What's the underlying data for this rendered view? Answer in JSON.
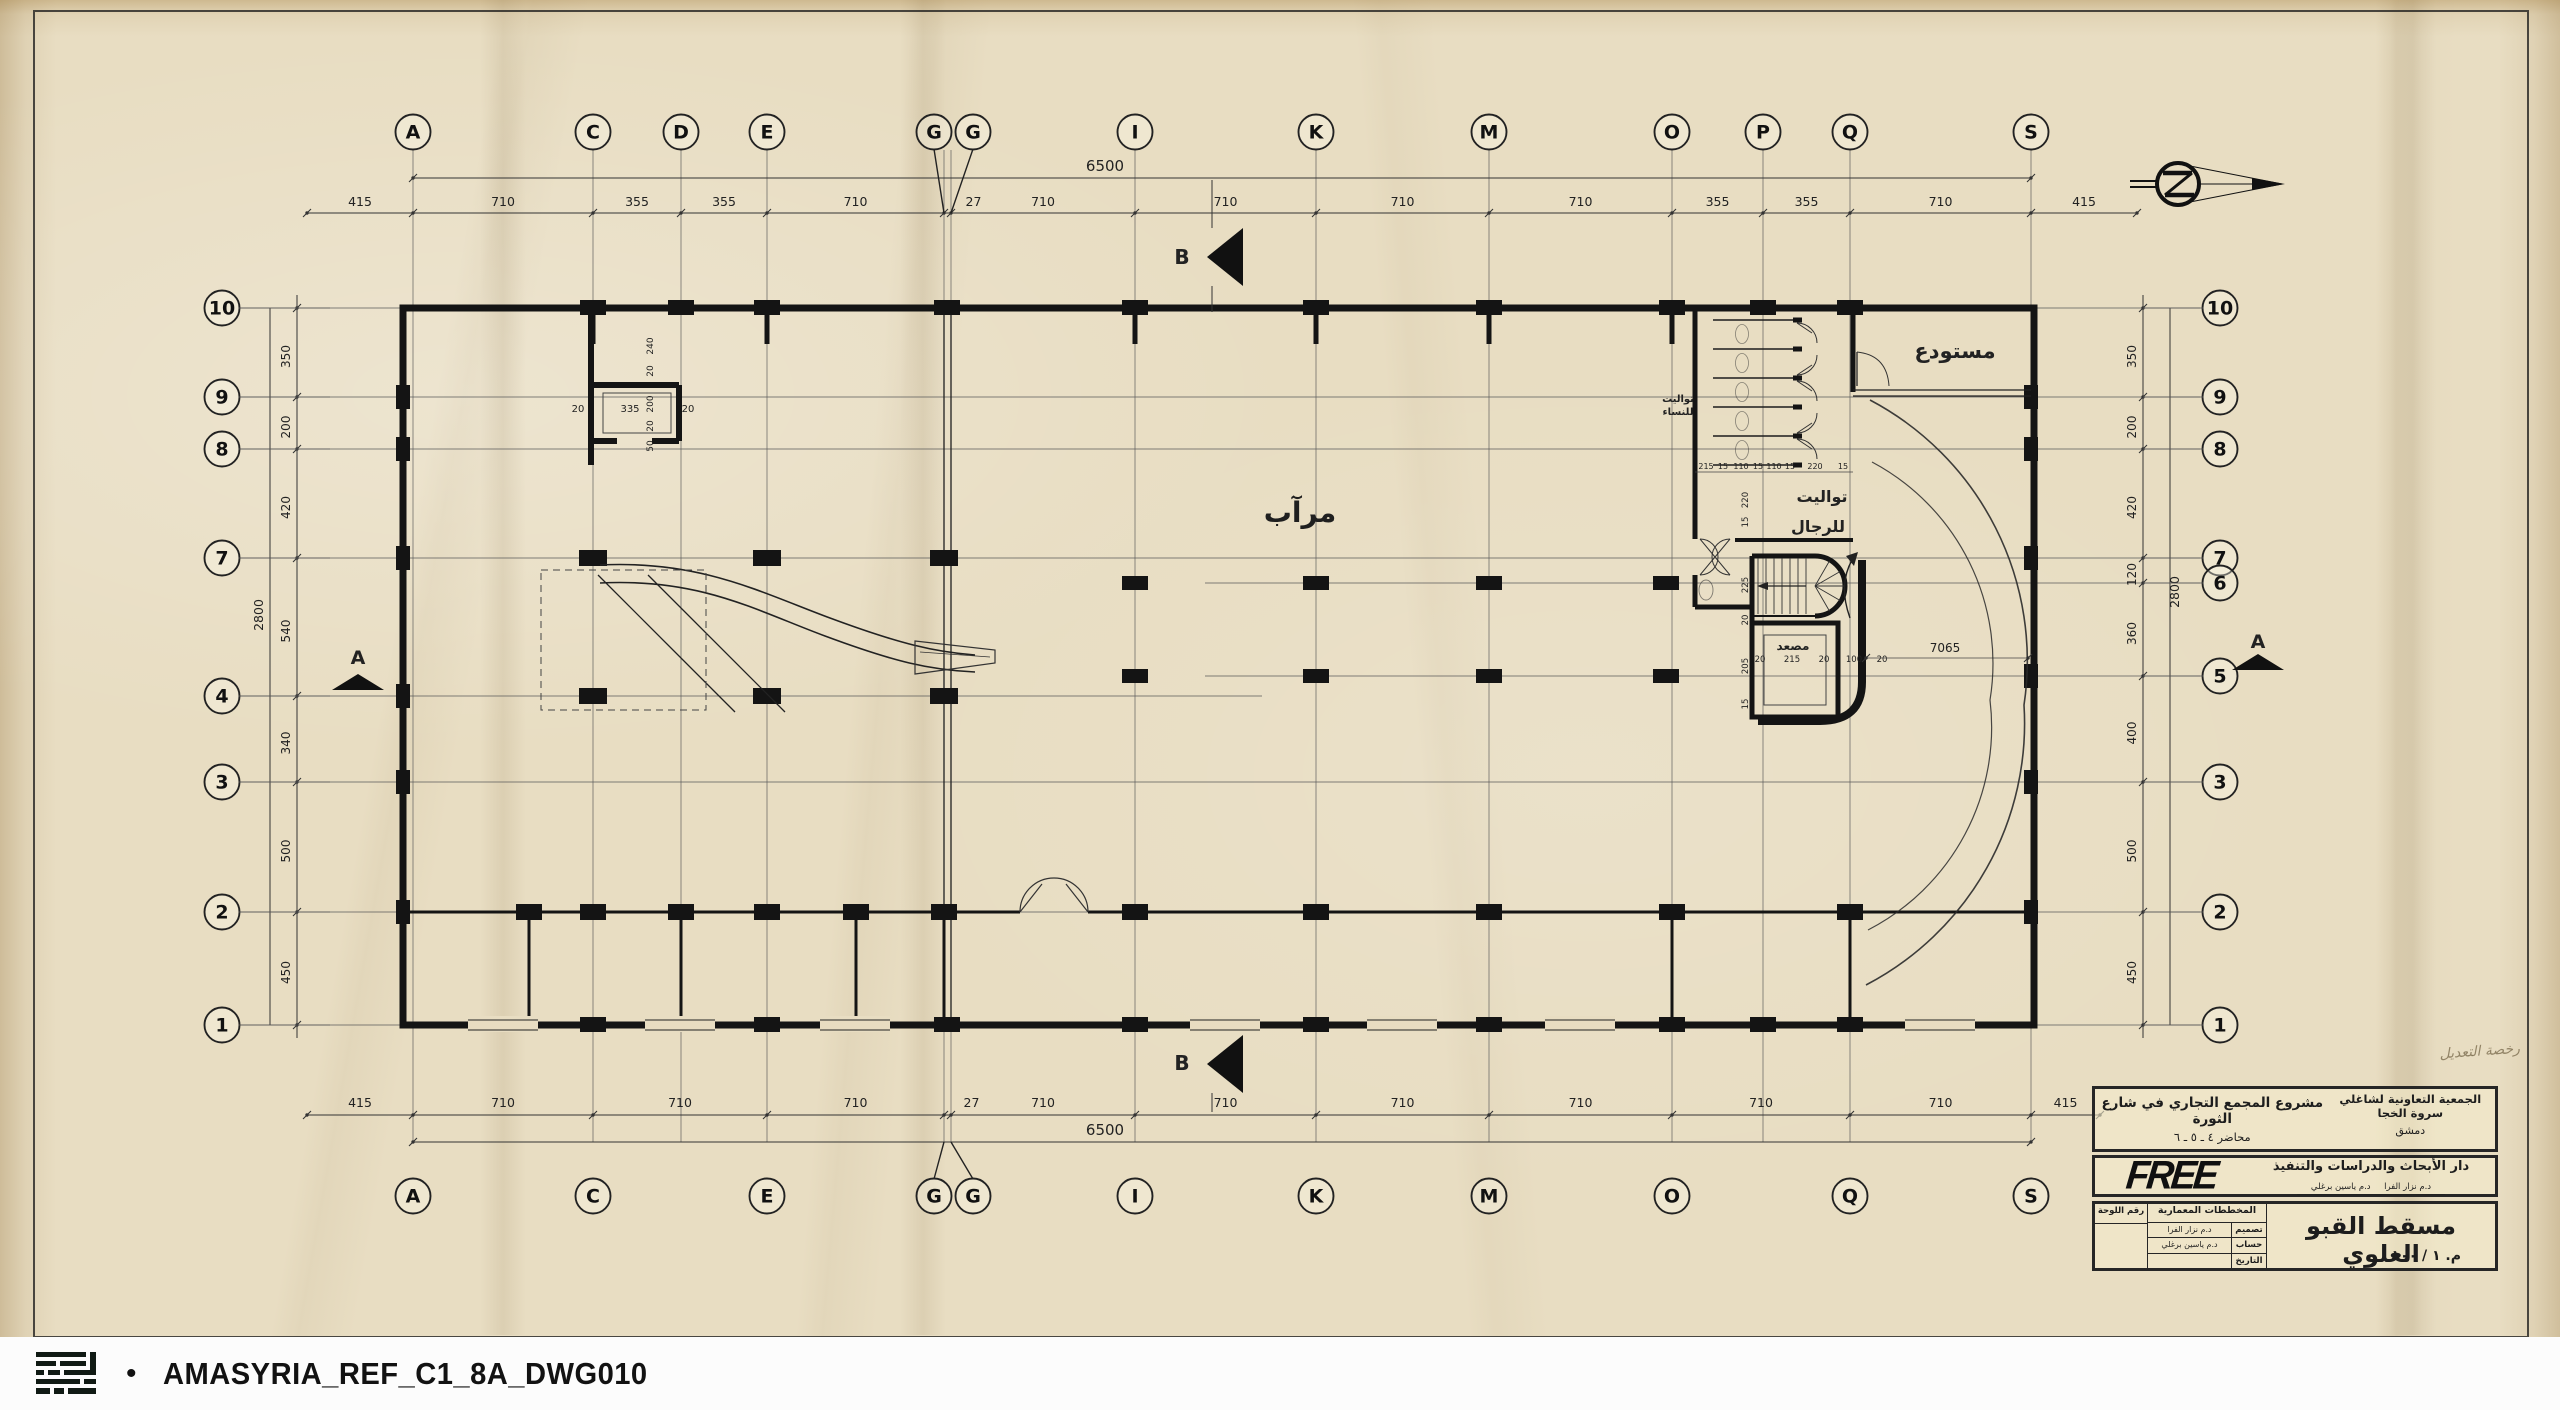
{
  "sheet": {
    "type": "architectural-floor-plan-scan"
  },
  "grid": {
    "top_labels": [
      "A",
      "C",
      "D",
      "E",
      "G",
      "G",
      "I",
      "K",
      "M",
      "O",
      "P",
      "Q",
      "S"
    ],
    "top_dims": [
      "415",
      "710",
      "355",
      "355",
      "710",
      "27",
      "710",
      "710",
      "710",
      "710",
      "355",
      "355",
      "710",
      "415"
    ],
    "top_total": "6500",
    "bottom_labels": [
      "A",
      "C",
      "E",
      "G",
      "G",
      "I",
      "K",
      "M",
      "O",
      "Q",
      "S"
    ],
    "bottom_dims": [
      "415",
      "710",
      "710",
      "710",
      "27",
      "710",
      "710",
      "710",
      "710",
      "710",
      "710",
      "415"
    ],
    "bottom_total": "6500",
    "left_labels": [
      "10",
      "9",
      "8",
      "7",
      "4",
      "3",
      "2",
      "1"
    ],
    "left_dims": [
      "350",
      "200",
      "420",
      "540",
      "340",
      "500",
      "450"
    ],
    "left_total": "2800",
    "right_labels": [
      "10",
      "9",
      "8",
      "7",
      "6",
      "5",
      "3",
      "2",
      "1"
    ],
    "right_dims": [
      "350",
      "200",
      "420",
      "120",
      "360",
      "400",
      "500",
      "450"
    ],
    "right_total": "2800"
  },
  "plan_labels": {
    "garage": "مرآب",
    "warehouse": "مستودع",
    "toilets_men_1": "تواليت",
    "toilets_men_2": "للرجال",
    "toilets_women_1": "تواليت",
    "toilets_women_2": "للنساء",
    "elevator": "مصعد"
  },
  "plan_dims": {
    "ramp_length": "7065",
    "shaft_v": [
      "240",
      "20",
      "200",
      "20",
      "50"
    ],
    "shaft_h": [
      "20",
      "335",
      "20"
    ],
    "elevator_row": [
      "20",
      "215",
      "20",
      "100",
      "20"
    ],
    "toilet_row": [
      "215",
      "15",
      "110",
      "15",
      "110",
      "15",
      "220",
      "15"
    ],
    "core_col": [
      "220",
      "15",
      "225",
      "20",
      "205",
      "15"
    ]
  },
  "section_markers": {
    "a": "A",
    "b": "B"
  },
  "annotations": {
    "permit_note": "رخصة التعديل"
  },
  "title_block": {
    "client_line1": "الجمعية التعاونية لشاغلي سروة الخجا",
    "client_line2": "دمشق",
    "project_line1": "مشروع المجمع التجاري في شارع الثورة",
    "project_line2": "محاضر ٤ ـ ٥ ـ ٦",
    "firm_name": "FREE",
    "firm_dept": "دار الأبحاث والدراسات والتنفيذ",
    "firm_names": "د.م نزار الفرا     د.م ياسين برغلي",
    "table_header": "المخططات المعمارية",
    "sheet_no_label": "رقم اللوحة",
    "design_label": "تصميم",
    "design_value": "د.م نزار الفرا",
    "calc_label": "حساب",
    "calc_value": "د.م ياسين برغلي",
    "date_label": "التاريخ",
    "drawing_title": "مسقط القبو العلوي",
    "scale": "م. ١ / ١٠٠"
  },
  "footer": {
    "bullet": "•",
    "caption": "AMASYRIA_REF_C1_8A_DWG010"
  }
}
